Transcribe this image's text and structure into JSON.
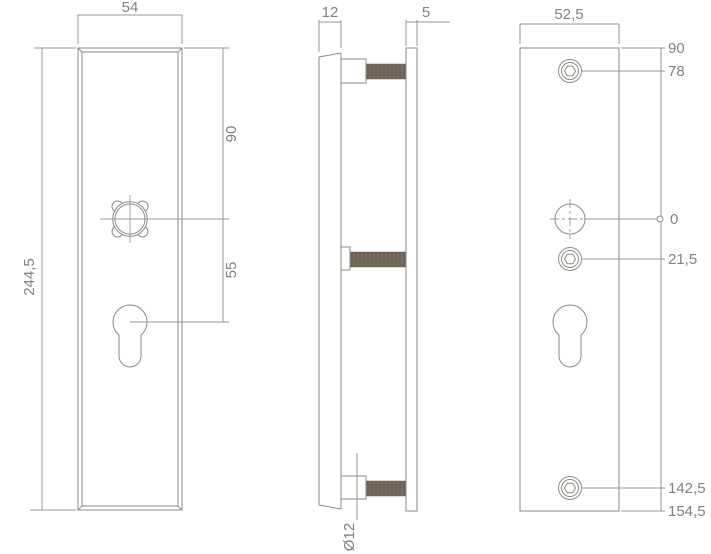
{
  "front_view": {
    "width": "54",
    "height": "244,5",
    "spindle_offset": "90",
    "cylinder_offset": "55"
  },
  "side_view": {
    "plate_thickness": "12",
    "back_plate_thickness": "5",
    "bolt_diameter": "Ø12"
  },
  "back_view": {
    "width": "52,5",
    "levels": [
      "90",
      "78",
      "0",
      "21,5",
      "142,5",
      "154,5"
    ]
  },
  "colors": {
    "line": "#8d8a83",
    "text": "#84817a",
    "thread_fill": "#6e6357",
    "background": "#ffffff"
  }
}
